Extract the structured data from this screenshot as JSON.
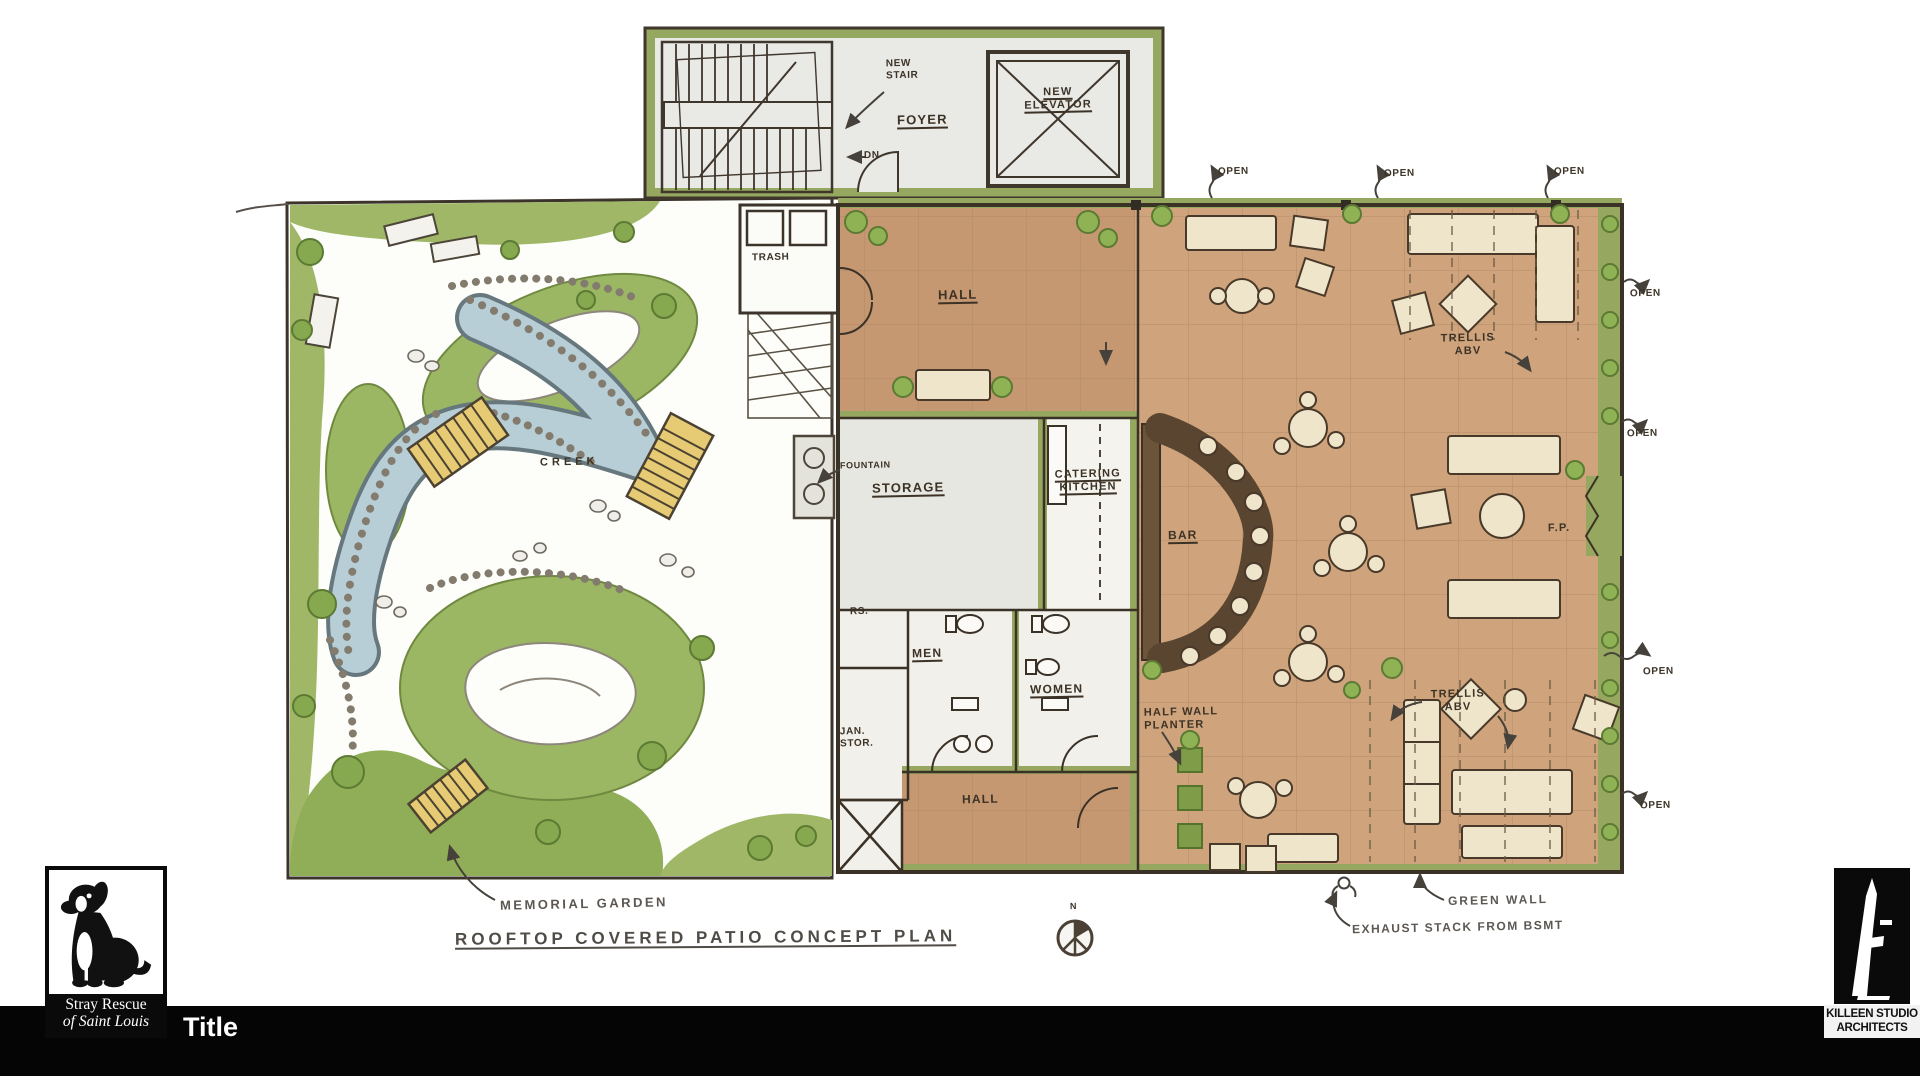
{
  "slide": {
    "footer_title": "Title",
    "drawing_title": "ROOFTOP COVERED PATIO CONCEPT PLAN"
  },
  "logos": {
    "stray_rescue": {
      "line1": "Stray Rescue",
      "line2": "of Saint Louis"
    },
    "killeen": {
      "line1": "KILLEEN STUDIO",
      "line2": "ARCHITECTS"
    }
  },
  "plan": {
    "north_label": "N",
    "labels": {
      "new_stair": "NEW\nSTAIR",
      "dn": "DN",
      "foyer": "FOYER",
      "new_elevator": "NEW\nELEVATOR",
      "trash": "TRASH",
      "hall_upper": "HALL",
      "fountain": "FOUNTAIN",
      "storage": "STORAGE",
      "catering_kitchen": "CATERING\nKITCHEN",
      "bar": "BAR",
      "rs": "RS.",
      "men": "MEN",
      "women": "WOMEN",
      "jan_stor": "JAN.\nSTOR.",
      "hall_lower": "HALL",
      "half_wall_planter": "HALF WALL\nPLANTER",
      "trellis_abv_upper": "TRELLIS\nABV",
      "trellis_abv_lower": "TRELLIS\nABV",
      "fireplace": "F.P.",
      "creek": "CREEK",
      "memorial_garden": "MEMORIAL GARDEN",
      "green_wall": "GREEN WALL",
      "exhaust_stack": "EXHAUST STACK FROM BSMT",
      "open": "OPEN"
    }
  },
  "colors": {
    "patio_tan": "#cfa47c",
    "hall_tan": "#c69871",
    "wall_olive": "#96a75f",
    "creek_blue": "#b7ced6",
    "bar_brown": "#5a4530",
    "bridge_yellow": "#e7cb74",
    "garden_green": "#9cb763",
    "ink": "#3c3226",
    "footer_black": "#050505"
  }
}
